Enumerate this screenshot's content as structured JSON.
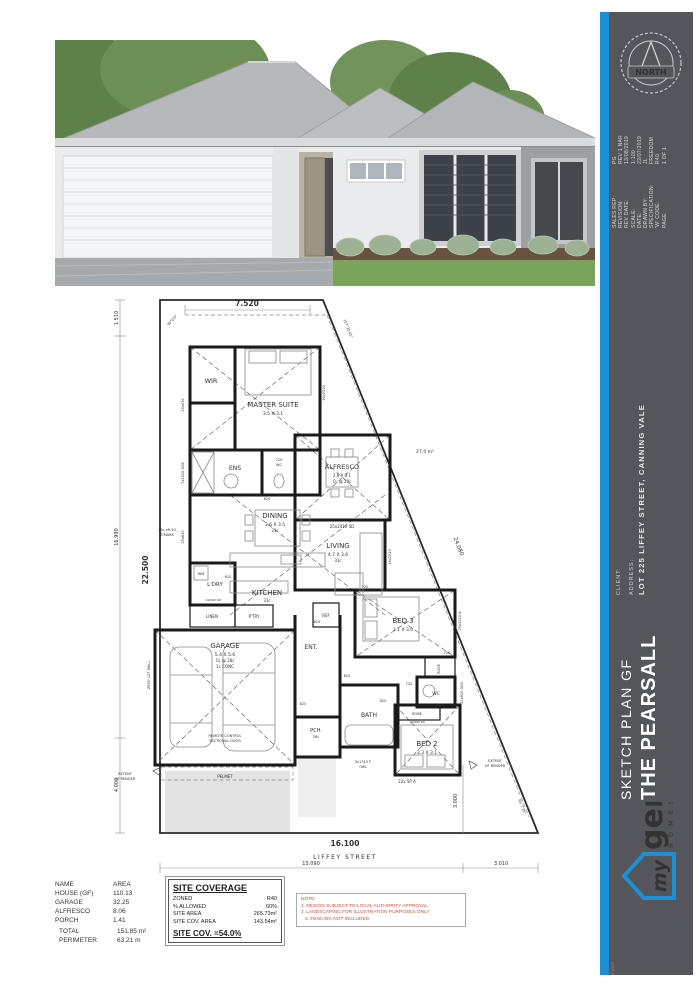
{
  "sidebar": {
    "accent_color": "#1e8fd5",
    "bg_color": "#54565b",
    "compass_label": "NORTH",
    "meta": [
      {
        "label": "SALES REP:",
        "value": "PG"
      },
      {
        "label": "REVISION:",
        "value": "REV 1 NAR"
      },
      {
        "label": "REV DATE:",
        "value": "13/08/2019"
      },
      {
        "label": "SCALE:",
        "value": "1:100"
      },
      {
        "label": "DATE:",
        "value": "22/07/2019"
      },
      {
        "label": "DRAWN BY:",
        "value": "JL"
      },
      {
        "label": "SPECIFICATION:",
        "value": "FREEDOM"
      },
      {
        "label": "'W' CODE:",
        "value": "R40"
      },
      {
        "label": "PAGE:",
        "value": "1 OF 1"
      }
    ],
    "client_label": "CLIENT:",
    "client_value": "",
    "address_label": "ADDRESS:",
    "address_value": "LOT 225 LIFFEY STREET, CANNING VALE",
    "plan_type": "SKETCH PLAN GF",
    "plan_name": "THE PEARSALL",
    "logo": {
      "word1": "my",
      "word2": "gen",
      "word3": "H O M E S"
    },
    "copyright": "© 2015"
  },
  "plan": {
    "dims": {
      "top": "7.520",
      "left_total": "22.500",
      "l1": "1.510",
      "l2": "16.990",
      "l3": "4.000",
      "bottom": "16.100",
      "street": "LIFFEY STREET",
      "b1": "13.090",
      "b2": "3.010",
      "diag": "24.080",
      "r1": "3.000",
      "a_tl": "90°0'0\"",
      "a_tr": "157°25'45\"",
      "a_br": "85°7'35\""
    },
    "rooms": {
      "wir": "WIR",
      "master": "MASTER SUITE",
      "master_size": "3.5 X 3.1",
      "ens": "ENS",
      "alfresco": "ALFRESCO",
      "alfresco_size": "2.6 X 3.1",
      "alfresco_cl": "CL @ 28c",
      "alfresco_area": "27.0 m²",
      "dining": "DINING",
      "dining_size": "3.6 X 3.5",
      "living": "LIVING",
      "living_size": "4.7 X 3.6",
      "kitchen": "KITCHEN",
      "cl31": "31c",
      "ldry": "L'DRY",
      "wm": "WM",
      "linen": "LINEN",
      "ptry": "P'TRY",
      "ref": "REF",
      "garage": "GARAGE",
      "garage_size": "5.4 X 5.6",
      "garage_cl": "CL @ 28c",
      "garage_floor": "1c CONC",
      "ent": "ENT.",
      "pch": "PCH.",
      "cl28": "28c",
      "bath": "BATH",
      "bed3": "BED 3",
      "bed3_size": "3.1 X 3.0",
      "bed2": "BED 2",
      "bed2_size": "3.3 X 3.1",
      "robe": "ROBE",
      "wc": "WC"
    },
    "openings": {
      "d820": "820",
      "d720": "720",
      "d620": "620",
      "w1": "16x2510",
      "w2": "25x610",
      "w3": "7x1010 OBS",
      "w4": "25x810",
      "w5": "25x1210 A",
      "w6": "12x610 OBS",
      "w7": "5x1310 F",
      "obs": "OBS",
      "w8": "22x SP A",
      "sd1": "25x2410 SD",
      "sd2": "1200W SD",
      "sd3": "1400W SD"
    },
    "notes": {
      "remote": "REMOTE CONTROL",
      "sectional": "SECTIONAL DOOR",
      "pelmet": "PELMET",
      "extent": "EXTENT",
      "of_render": "OF RENDER",
      "zero": "ZERO LOT WALL",
      "bmark1": "25c eff 40",
      "bmark2": "B'MARK"
    }
  },
  "area_table": {
    "col1": "NAME",
    "col2": "AREA",
    "rows": [
      [
        "HOUSE (GF)",
        "110.13"
      ],
      [
        "GARAGE",
        "32.25"
      ],
      [
        "ALFRESCO",
        "8.06"
      ],
      [
        "PORCH",
        "1.41"
      ]
    ],
    "total_label": "TOTAL",
    "total_value": "151.85 m²",
    "perimeter_label": "PERIMETER",
    "perimeter_value": "63.21 m"
  },
  "site_coverage": {
    "title": "SITE COVERAGE",
    "rows": [
      [
        "ZONED",
        "R40"
      ],
      [
        "% ALLOWED",
        "60%"
      ],
      [
        "SITE AREA",
        "265.73m²"
      ],
      [
        "SITE COV. AREA",
        "143.54m²"
      ]
    ],
    "result": "SITE COV. =54.0%"
  },
  "note_box": {
    "color": "#c8502e",
    "l1": "NOTE:",
    "l2": "1. DESIGN SUBJECT TO LOCAL AUTHORITY APPROVAL.",
    "l3": "2. LANDSCAPING FOR ILLUSTRATION PURPOSES ONLY",
    "l4": "3. FENCING NOT INCLUDED"
  },
  "render_colors": {
    "roof": "#b6b9bc",
    "wall": "#e9ebec",
    "window": "#3d4248",
    "lawn": "#79a45a",
    "accent_wall": "#9ca0a3"
  }
}
